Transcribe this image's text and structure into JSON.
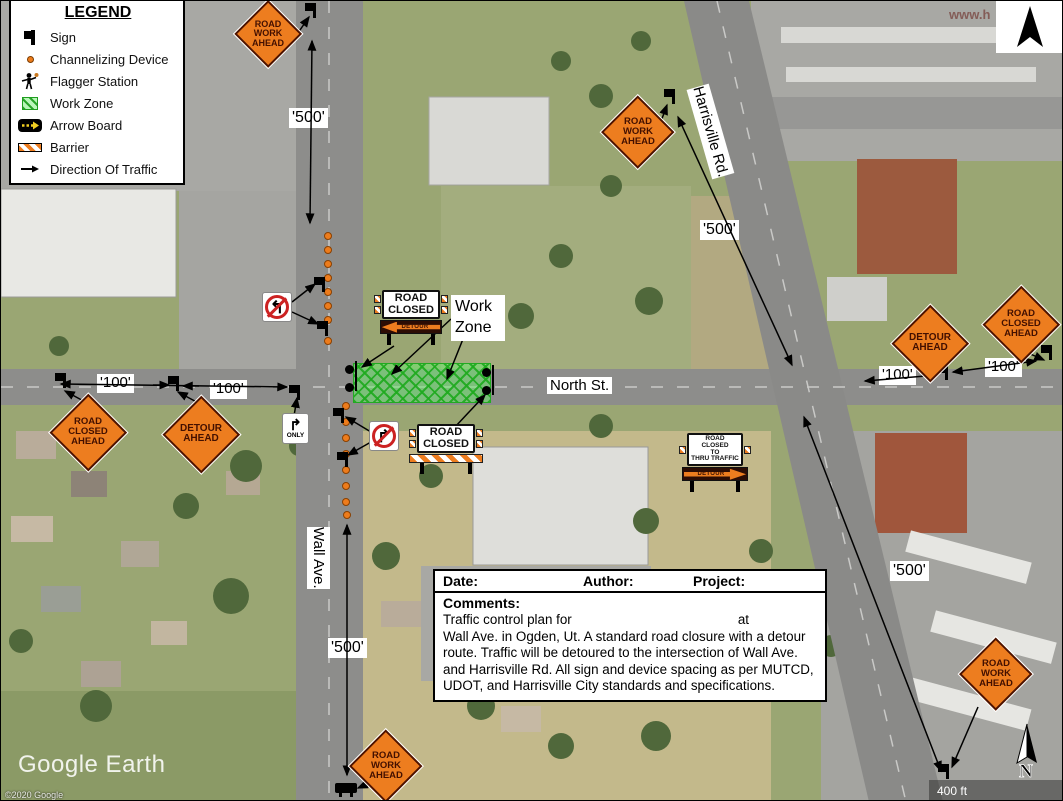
{
  "map": {
    "source_watermark": "Google Earth",
    "copyright": "©2020 Google",
    "scale_label": "400 ft",
    "north_label": "N",
    "url_watermark": "www.h"
  },
  "legend": {
    "title": "LEGEND",
    "items": [
      {
        "label": "Sign",
        "icon": "sign-icon"
      },
      {
        "label": "Channelizing Device",
        "icon": "channelizing-device-icon"
      },
      {
        "label": "Flagger Station",
        "icon": "flagger-station-icon"
      },
      {
        "label": "Work Zone",
        "icon": "work-zone-icon"
      },
      {
        "label": "Arrow Board",
        "icon": "arrow-board-icon"
      },
      {
        "label": "Barrier",
        "icon": "barrier-icon"
      },
      {
        "label": "Direction Of Traffic",
        "icon": "direction-of-traffic-icon"
      }
    ]
  },
  "streets": {
    "north": "North St.",
    "wall": "Wall Ave.",
    "harrisville": "Harrisville Rd."
  },
  "dimensions": {
    "d500": "'500'",
    "d100": "'100'"
  },
  "sign_text": {
    "road_work_ahead": [
      "ROAD",
      "WORK",
      "AHEAD"
    ],
    "road_closed_ahead": [
      "ROAD",
      "CLOSED",
      "AHEAD"
    ],
    "detour_ahead": [
      "DETOUR",
      "AHEAD"
    ],
    "road_closed": [
      "ROAD",
      "CLOSED"
    ],
    "road_closed_thru": [
      "ROAD CLOSED",
      "TO",
      "THRU TRAFFIC"
    ],
    "detour": "DETOUR",
    "only": "ONLY"
  },
  "annotations": {
    "work_zone": [
      "Work",
      "Zone"
    ]
  },
  "info_box": {
    "date_label": "Date:",
    "author_label": "Author:",
    "project_label": "Project:",
    "comments_label": "Comments:",
    "line1_prefix": "Traffic control plan for",
    "line1_suffix": "at",
    "body": "Wall Ave. in Ogden, Ut. A standard road closure with a detour route. Traffic will be detoured to the intersection of Wall Ave. and Harrisville Rd. All sign and device spacing as per MUTCD, UDOT, and Harrisville City standards and specifications."
  },
  "colors": {
    "sign_orange": "#ED7D1F",
    "work_zone_green": "#55D055",
    "cone_orange": "#ED7C1C",
    "road_gray": "#8d8d8b"
  }
}
